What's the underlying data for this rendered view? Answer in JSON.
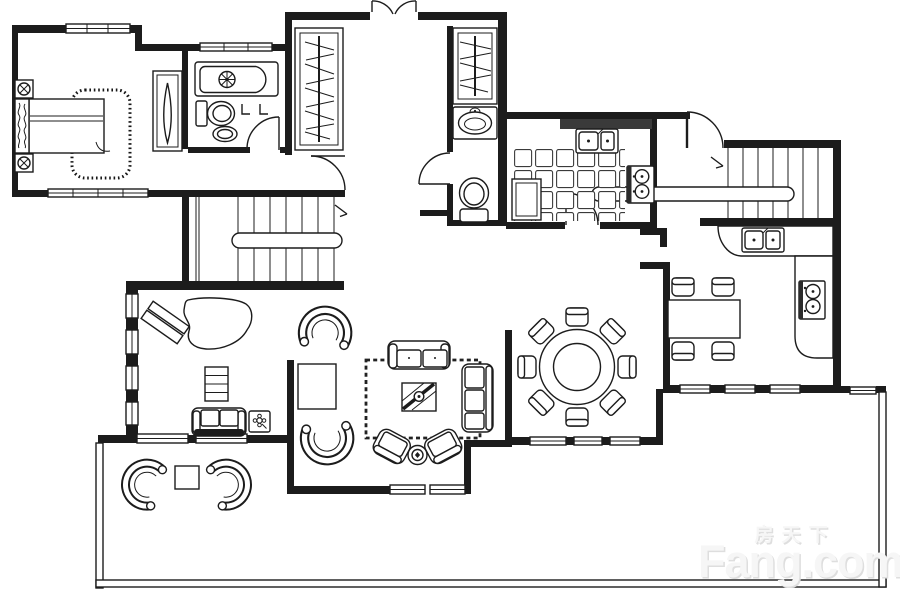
{
  "image": {
    "kind": "real-estate floor plan drawing",
    "background": "#ffffff",
    "line_color": "#1c1c1c",
    "counter_fill": "#3a3a3a",
    "watermark_color": "#ededed"
  },
  "watermark": {
    "brand_cn": "房天下",
    "brand_en": "Fang.com"
  },
  "legend": {
    "symbols": [
      "double-bed",
      "headboard",
      "nightstand-lamp",
      "area-rug",
      "dresser-cabinet",
      "wardrobe-hanging-rail",
      "bathtub",
      "toilet",
      "pedestal-basin",
      "vanity-basin",
      "towel-hooks",
      "kitchen-double-sink",
      "gas-stove-2-burner",
      "floor-tiles",
      "base-cabinet",
      "kitchen-counter",
      "staircase-u-shaped",
      "staircase-straight",
      "handrail",
      "direction-arrow",
      "round-dining-table",
      "dining-chair",
      "rect-table",
      "side-chair",
      "two-seat-sofa",
      "three-seat-sofa",
      "coffee-table",
      "armchair",
      "round-side-table",
      "grand-piano",
      "piano-bench",
      "bookshelf",
      "flower-side-table",
      "wicker-chair",
      "terrace-table",
      "window-band",
      "door-swing",
      "double-entry-door",
      "terrace-railing"
    ]
  }
}
